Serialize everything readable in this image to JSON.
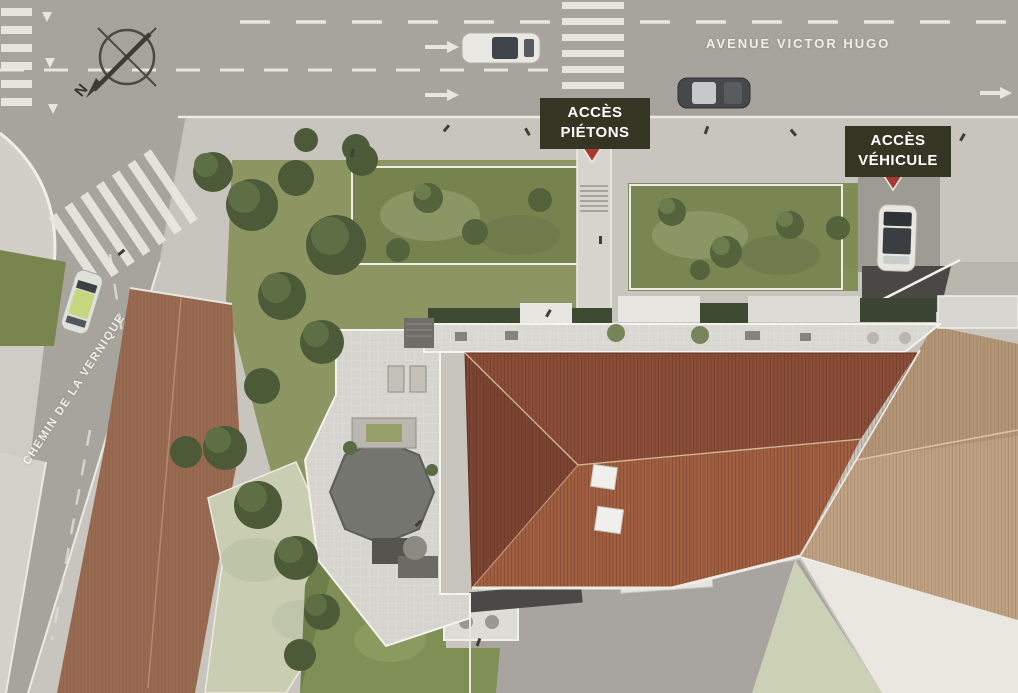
{
  "labels": {
    "avenue": "AVENUE VICTOR HUGO",
    "chemin": "CHEMIN DE LA VERNIQUE",
    "acces_pietons_line1": "ACCÈS",
    "acces_pietons_line2": "PIÉTONS",
    "acces_vehicule_line1": "ACCÈS",
    "acces_vehicule_line2": "VÉHICULE",
    "compass_north": "N"
  },
  "colors": {
    "road": "#a7a49d",
    "sidewalk": "#c8c5be",
    "plaza": "#d2cfc8",
    "road_marking": "#f0eee7",
    "label_background": "#343523",
    "label_text": "#ffffff",
    "access_marker_red": "#a83832",
    "main_roof_dark": "#82462f",
    "main_roof_mid": "#8a4e38",
    "main_roof_light": "#a05f41",
    "adjacent_roof_tan": "#bfa284",
    "left_building_roof": "#996a52",
    "green_roof_pale": "#c9ceb3",
    "terrace": "#d6d4ce",
    "garden_green": "#8d9663",
    "tree_dark": "#4c5a38",
    "lawn": "#7f8f55"
  }
}
